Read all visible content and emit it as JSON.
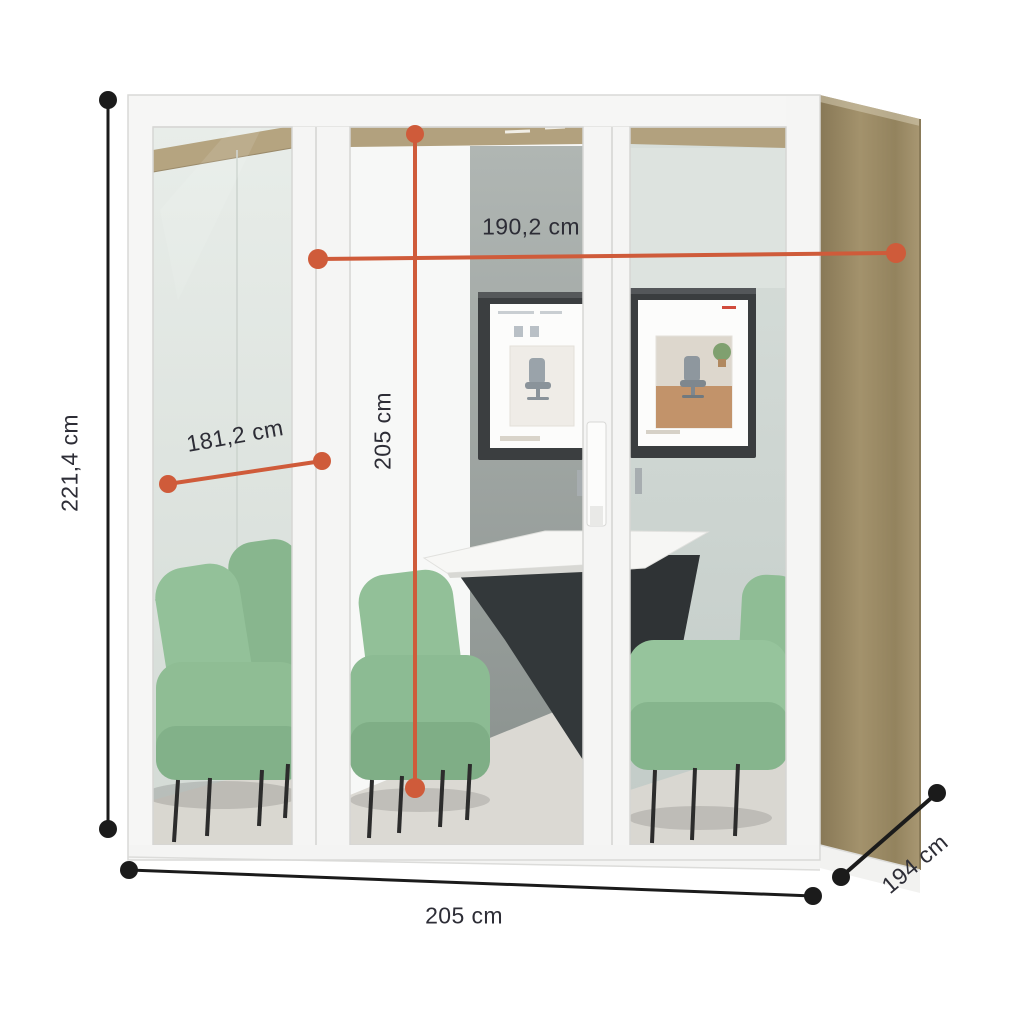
{
  "dimensions": {
    "external_height": {
      "label": "221,4 cm"
    },
    "internal_width": {
      "label": "190,2 cm"
    },
    "glass_diagonal": {
      "label": "181,2 cm"
    },
    "internal_height": {
      "label": "205 cm"
    },
    "external_width": {
      "label": "205 cm"
    },
    "external_depth": {
      "label": "194 cm"
    }
  },
  "colors": {
    "dimension_accent": "#cf5b3a",
    "dimension_neutral": "#1b1b1b",
    "label_text": "#2d2d36",
    "wood_panel": "#9c8c66",
    "sofa_green": "#8fbd94",
    "ceiling_acoustic": "#b3a27e",
    "frame_white": "#f6f6f5"
  }
}
